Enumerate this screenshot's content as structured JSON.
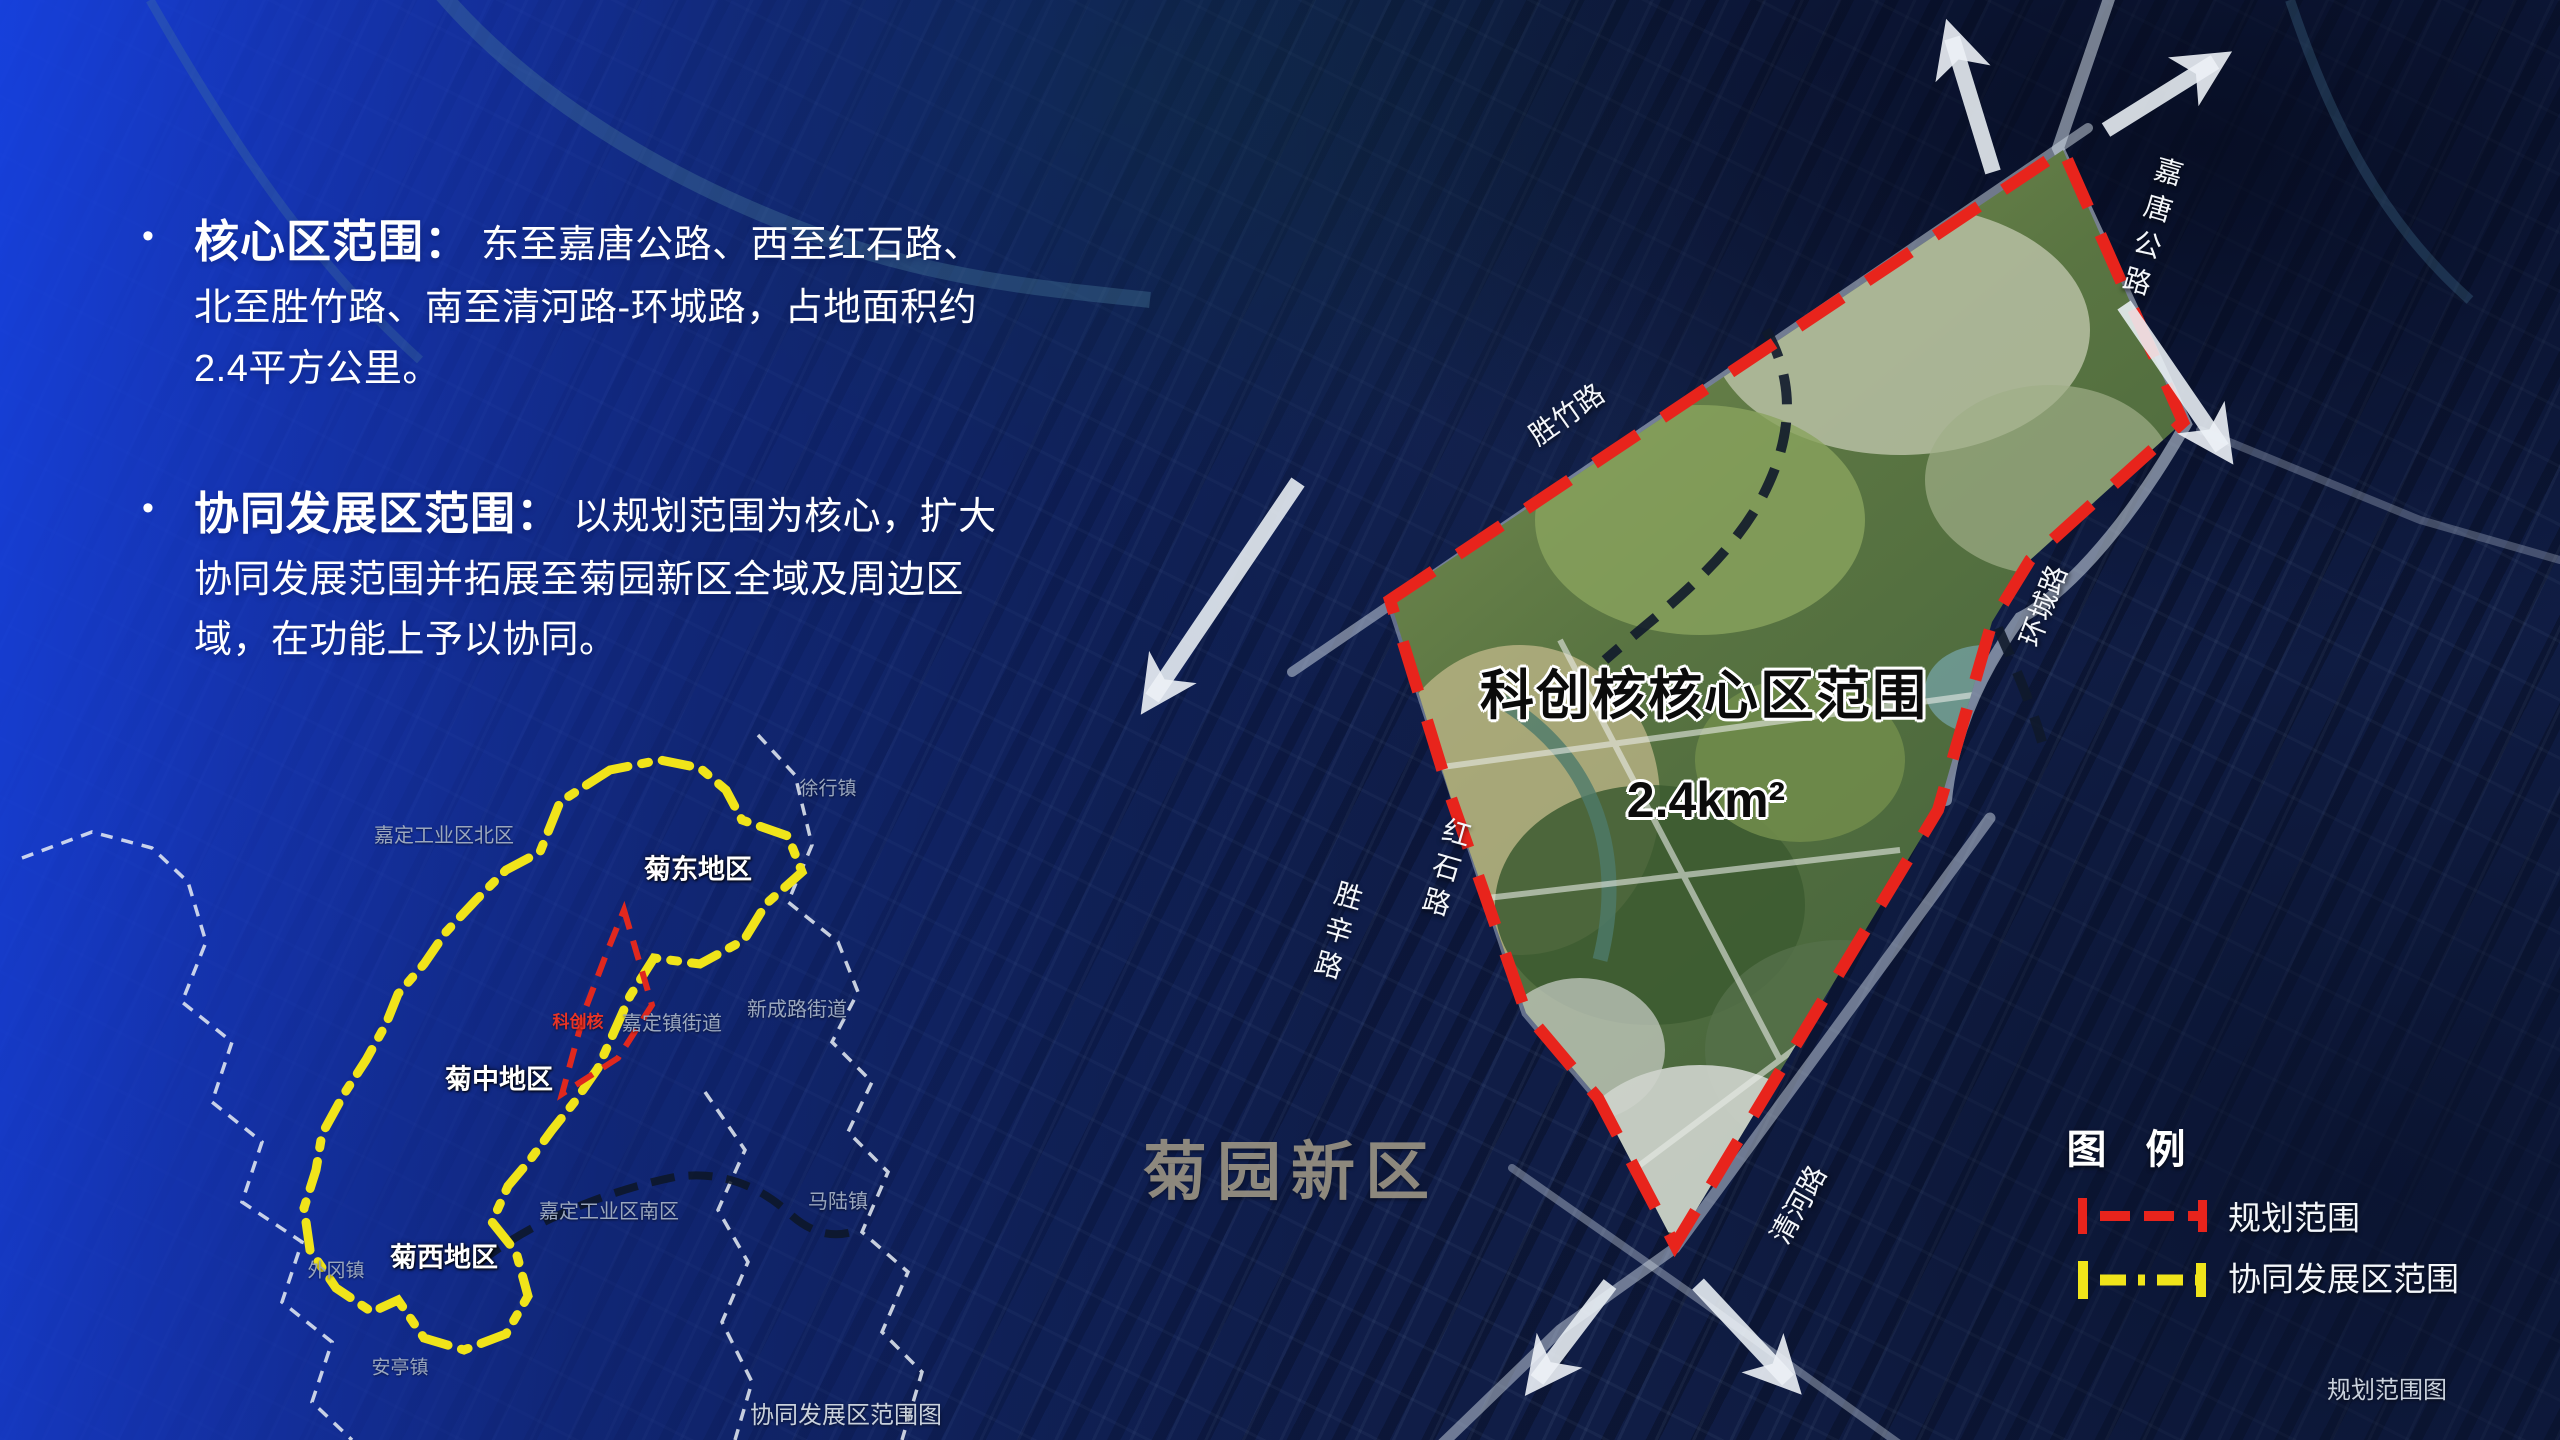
{
  "panel": {
    "bullet_marker": "•",
    "bullets": [
      {
        "title": "核心区范围：",
        "text": "东至嘉唐公路、西至红石路、北至胜竹路、南至清河路-环城路，占地面积约2.4平方公里。"
      },
      {
        "title": "协同发展区范围：",
        "text": "以规划范围为核心，扩大协同发展范围并拓展至菊园新区全域及周边区域，在功能上予以协同。"
      }
    ]
  },
  "main_map": {
    "core_title": "科创核核心区范围",
    "core_area": "2.4km²",
    "district_name": "菊园新区",
    "roads": [
      "胜竹路",
      "嘉唐公路",
      "环城路",
      "红石路",
      "胜辛路",
      "清河路"
    ],
    "caption": "规划范围图"
  },
  "inset_map": {
    "caption": "协同发展区范围图",
    "core_label": "科创核",
    "regions": [
      "菊东地区",
      "菊中地区",
      "菊西地区"
    ],
    "places": [
      "徐行镇",
      "嘉定工业区北区",
      "新成路街道",
      "嘉定镇街道",
      "马陆镇",
      "嘉定工业区南区",
      "外冈镇",
      "安亭镇"
    ]
  },
  "legend": {
    "title": "图  例",
    "items": [
      {
        "label": "规划范围",
        "color": "#e8241c",
        "style": "dashed"
      },
      {
        "label": "协同发展区范围",
        "color": "#f0e41a",
        "style": "dash-dot"
      }
    ]
  },
  "colors": {
    "panel_blue": "#1742e4",
    "boundary_red": "#e8241c",
    "boundary_yellow": "#f0e41a",
    "district_label_gray": "#999283"
  }
}
